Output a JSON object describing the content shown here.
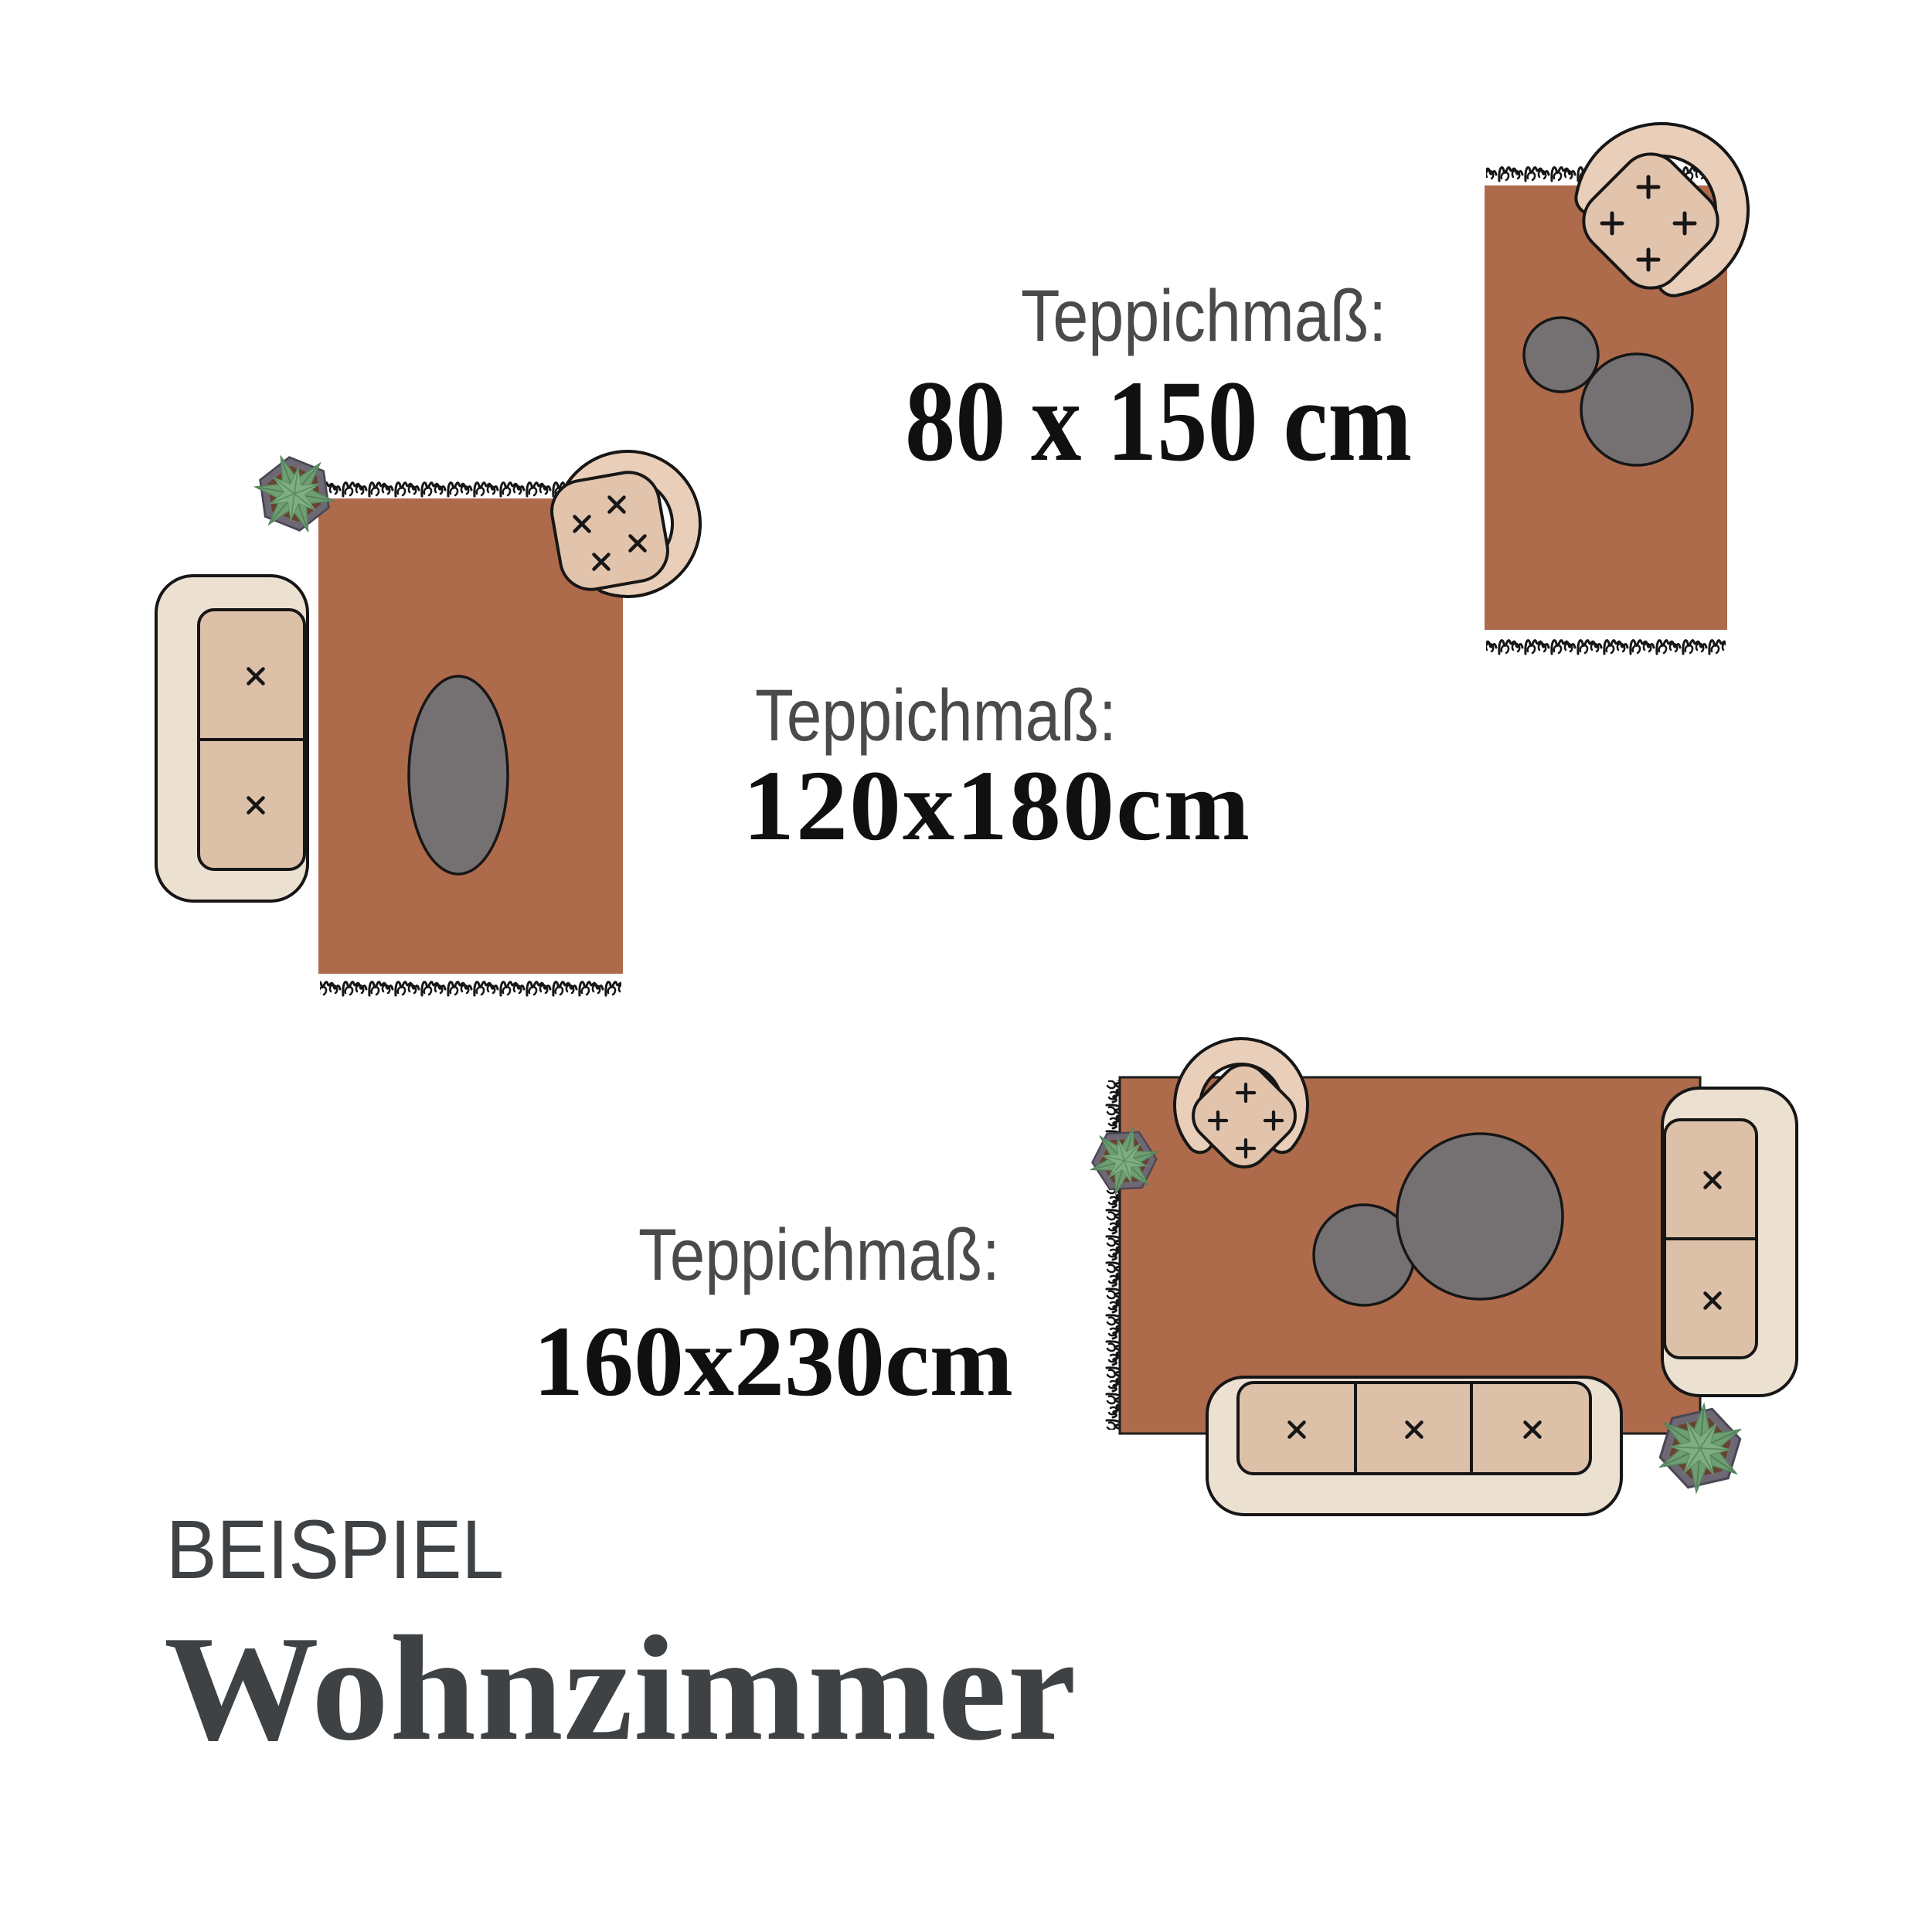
{
  "heading": {
    "eyebrow": "BEISPIEL",
    "title": "Wohnzimmer"
  },
  "scenes": [
    {
      "id": "80x150",
      "label": "Teppichmaß:",
      "size": "80 x 150 cm"
    },
    {
      "id": "120x180",
      "label": "Teppichmaß:",
      "size": "120x180cm"
    },
    {
      "id": "160x230",
      "label": "Teppichmaß:",
      "size": "160x230cm"
    }
  ],
  "colors": {
    "rug": "#ae6b4c",
    "rug_outline": "#1c1c1c",
    "sofa_cream": "#ece0d1",
    "cushion_tan": "#dcc0a8",
    "chair_shell": "#e9cfba",
    "chair_seat": "#e2c3ac",
    "table_grey": "#757071",
    "leaf_green": "#6f9e73",
    "leaf_green_light": "#7fae82",
    "pot_grey": "#6e6875",
    "soil_brown": "#69422f",
    "label_grey": "#4a4a4c",
    "size_black": "#101010",
    "heading_grey": "#3e4245"
  }
}
